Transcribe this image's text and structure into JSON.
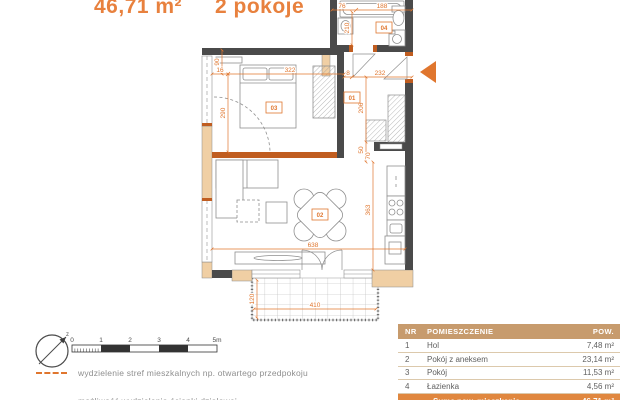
{
  "header": {
    "area": "46,71 m²",
    "rooms": "2 pokoje"
  },
  "plan": {
    "room_labels": {
      "hall": "01",
      "living": "02",
      "bedroom": "03",
      "bath": "04"
    },
    "dims": {
      "bed_offset": "16",
      "bed_width": "322",
      "bed_height": "290",
      "bed_window": "90",
      "bath_left": "76",
      "bath_tub": "188",
      "bath_depth": "210",
      "hall_offset": "8",
      "hall_width": "232",
      "hall_depth": "206",
      "hall_small": "50",
      "kitchen_top": "70",
      "living_depth": "363",
      "living_width": "638",
      "balcony_width": "410",
      "balcony_depth": "120"
    },
    "compass_letter": "z",
    "colors": {
      "accent_orange": "#e0762e",
      "wall_dark": "#4a4a4a",
      "wall_tan": "#f0cfa4",
      "partition_orange": "#c05d20",
      "table_header_bg": "#c79b6d",
      "total_row_bg": "#e0873f"
    }
  },
  "scalebar": {
    "ticks": [
      "0",
      "1",
      "2",
      "3",
      "4",
      "5m"
    ]
  },
  "legend": {
    "items": [
      {
        "text": "wydzielenie stref mieszkalnych np. otwartego przedpokoju"
      },
      {
        "text": "możliwość wydzielenia ścianki działowej"
      }
    ]
  },
  "table": {
    "columns": [
      "NR",
      "POMIESZCZENIE",
      "POW."
    ],
    "rows": [
      {
        "nr": "1",
        "name": "Hol",
        "area": "7,48 m²"
      },
      {
        "nr": "2",
        "name": "Pokój z aneksem",
        "area": "23,14 m²"
      },
      {
        "nr": "3",
        "name": "Pokój",
        "area": "11,53 m²"
      },
      {
        "nr": "4",
        "name": "Łazienka",
        "area": "4,56 m²"
      }
    ],
    "footer": {
      "label": "Suma pow. mieszkania",
      "value": "46,71 m²"
    }
  }
}
